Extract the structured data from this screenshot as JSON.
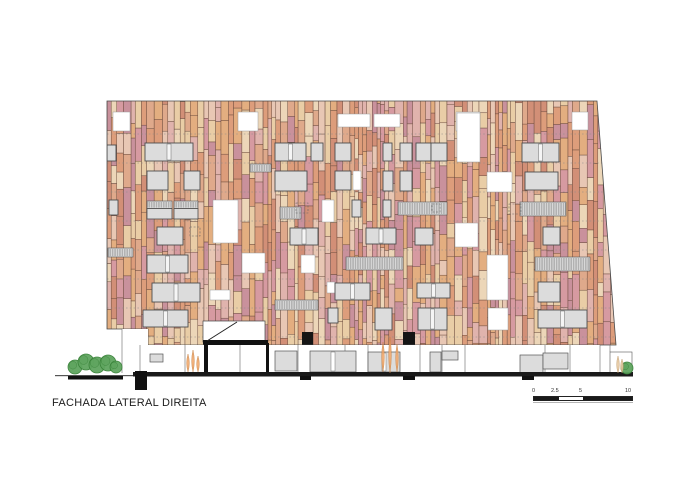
{
  "title": "FACHADA LATERAL DIREITA",
  "scale_bar": {
    "labels": [
      "0",
      "2.5",
      "5",
      "10"
    ]
  },
  "drawing": {
    "canvas": {
      "w": 700,
      "h": 495
    },
    "facade": {
      "clip_polygon": [
        [
          107,
          101
        ],
        [
          597,
          101
        ],
        [
          616,
          345
        ],
        [
          148,
          345
        ],
        [
          148,
          329
        ],
        [
          107,
          329
        ]
      ],
      "x0": 107,
      "x1": 617,
      "y_top": 101,
      "y_bottom": 345,
      "seed": 1337,
      "palette": [
        "#e3ae80",
        "#dd9d7b",
        "#d69aa1",
        "#e8c7b4",
        "#e9cda6",
        "#d28f77",
        "#c9919c",
        "#ecd6b8",
        "#dfa98b",
        "#e0b3ad"
      ],
      "plank_outline": "#6a4a3c",
      "edge_color": "#4a4a4a",
      "floor_line_ys": [
        134,
        163,
        192,
        221,
        250,
        279,
        308,
        337
      ],
      "floor_line_color": "#8a8a8a"
    },
    "window_colors": {
      "glass": "#dcdcdc",
      "frame": "#4d4d4d",
      "open": "#ffffff",
      "open_stroke": "#999999",
      "louver": "#d8d8d8",
      "louver_line": "#777777",
      "dark": "#151515",
      "dash": "#666666",
      "mullion": "#f5f5f5"
    },
    "windows": [
      [
        113,
        112,
        17,
        19,
        "o"
      ],
      [
        238,
        112,
        20,
        19,
        "o"
      ],
      [
        338,
        114,
        32,
        13,
        "o"
      ],
      [
        374,
        114,
        26,
        13,
        "o"
      ],
      [
        456,
        112,
        24,
        19,
        "o"
      ],
      [
        572,
        112,
        16,
        18,
        "o"
      ],
      [
        107,
        145,
        9,
        16,
        "g"
      ],
      [
        145,
        143,
        48,
        18,
        "g2"
      ],
      [
        275,
        143,
        31,
        18,
        "g2"
      ],
      [
        311,
        143,
        12,
        18,
        "g"
      ],
      [
        335,
        143,
        16,
        18,
        "g"
      ],
      [
        383,
        143,
        9,
        18,
        "g"
      ],
      [
        400,
        143,
        12,
        18,
        "g"
      ],
      [
        416,
        143,
        15,
        18,
        "g"
      ],
      [
        431,
        143,
        16,
        18,
        "g"
      ],
      [
        457,
        113,
        23,
        49,
        "o"
      ],
      [
        522,
        143,
        37,
        19,
        "g2"
      ],
      [
        147,
        171,
        21,
        19,
        "g"
      ],
      [
        184,
        171,
        16,
        19,
        "g"
      ],
      [
        250,
        164,
        21,
        8,
        "l"
      ],
      [
        275,
        171,
        32,
        20,
        "g"
      ],
      [
        335,
        171,
        16,
        19,
        "g"
      ],
      [
        353,
        171,
        8,
        19,
        "o"
      ],
      [
        383,
        171,
        10,
        20,
        "g"
      ],
      [
        400,
        171,
        12,
        20,
        "g"
      ],
      [
        487,
        172,
        25,
        20,
        "o"
      ],
      [
        525,
        172,
        33,
        18,
        "g"
      ],
      [
        109,
        200,
        9,
        15,
        "g"
      ],
      [
        147,
        201,
        25,
        18,
        "gl"
      ],
      [
        174,
        201,
        24,
        18,
        "gl"
      ],
      [
        213,
        200,
        25,
        43,
        "o"
      ],
      [
        280,
        207,
        21,
        12,
        "l"
      ],
      [
        322,
        200,
        12,
        22,
        "o"
      ],
      [
        352,
        200,
        9,
        17,
        "g"
      ],
      [
        383,
        200,
        8,
        17,
        "g"
      ],
      [
        398,
        202,
        49,
        13,
        "l"
      ],
      [
        520,
        202,
        46,
        14,
        "l"
      ],
      [
        296,
        203,
        12,
        10,
        "dash"
      ],
      [
        509,
        204,
        12,
        10,
        "dash"
      ],
      [
        432,
        204,
        8,
        8,
        "dash"
      ],
      [
        157,
        227,
        26,
        18,
        "g"
      ],
      [
        190,
        227,
        10,
        9,
        "dash"
      ],
      [
        290,
        228,
        28,
        17,
        "g2"
      ],
      [
        366,
        228,
        30,
        16,
        "g2"
      ],
      [
        415,
        228,
        18,
        17,
        "g"
      ],
      [
        455,
        223,
        23,
        24,
        "o"
      ],
      [
        543,
        227,
        17,
        18,
        "g"
      ],
      [
        108,
        248,
        25,
        9,
        "l"
      ],
      [
        147,
        255,
        41,
        18,
        "g2"
      ],
      [
        242,
        253,
        23,
        20,
        "o"
      ],
      [
        301,
        255,
        14,
        18,
        "o"
      ],
      [
        346,
        257,
        57,
        13,
        "l"
      ],
      [
        487,
        255,
        21,
        45,
        "o"
      ],
      [
        535,
        257,
        55,
        14,
        "l"
      ],
      [
        152,
        283,
        48,
        19,
        "g2"
      ],
      [
        327,
        282,
        8,
        11,
        "o"
      ],
      [
        335,
        283,
        35,
        17,
        "g2"
      ],
      [
        417,
        283,
        33,
        15,
        "g2"
      ],
      [
        538,
        282,
        22,
        20,
        "g"
      ],
      [
        210,
        290,
        20,
        10,
        "o"
      ],
      [
        275,
        300,
        43,
        10,
        "l"
      ],
      [
        143,
        310,
        45,
        17,
        "g2"
      ],
      [
        328,
        308,
        10,
        15,
        "g"
      ],
      [
        375,
        308,
        17,
        22,
        "g"
      ],
      [
        418,
        308,
        29,
        22,
        "g2"
      ],
      [
        488,
        308,
        20,
        22,
        "o"
      ],
      [
        538,
        310,
        49,
        18,
        "g2"
      ],
      [
        302,
        332,
        11,
        13,
        "d"
      ],
      [
        403,
        332,
        12,
        15,
        "d"
      ]
    ],
    "entrance": {
      "box": [
        203,
        321,
        62,
        21
      ],
      "bar": [
        203,
        340,
        65,
        4.5
      ],
      "diag": [
        207,
        341,
        237,
        322
      ]
    },
    "ground": {
      "white_areas": [
        [
          122,
          329,
          26,
          44
        ],
        [
          122,
          345,
          478,
          28
        ]
      ],
      "verticals": [
        [
          122,
          329,
          373
        ],
        [
          140,
          345,
          373
        ],
        [
          185,
          345,
          373
        ],
        [
          240,
          345,
          373
        ],
        [
          298,
          345,
          373
        ],
        [
          345,
          345,
          373
        ],
        [
          368,
          345,
          373
        ],
        [
          420,
          345,
          373
        ],
        [
          442,
          345,
          373
        ],
        [
          465,
          345,
          373
        ],
        [
          545,
          345,
          373
        ],
        [
          570,
          345,
          373
        ],
        [
          600,
          345,
          373
        ],
        [
          610,
          345,
          352
        ]
      ],
      "panels": [
        [
          150,
          354,
          13,
          8,
          "g"
        ],
        [
          275,
          351,
          22,
          20,
          "g"
        ],
        [
          310,
          351,
          46,
          21,
          "g2"
        ],
        [
          368,
          352,
          32,
          20,
          "g2"
        ],
        [
          430,
          352,
          11,
          20,
          "g"
        ],
        [
          442,
          351,
          16,
          9,
          "g"
        ],
        [
          520,
          355,
          23,
          18,
          "g"
        ],
        [
          543,
          353,
          25,
          16,
          "g"
        ]
      ],
      "posts": [
        [
          204,
          343,
          4,
          30
        ],
        [
          266,
          343,
          3,
          30
        ]
      ],
      "beam": [
        204,
        341,
        64,
        4
      ],
      "ground_line": [
        133,
        372,
        500,
        4.5
      ],
      "left_line": [
        55,
        375,
        80,
        1.2
      ],
      "planter": [
        68,
        376,
        55,
        3.5
      ],
      "big_post": [
        135,
        371,
        12,
        19
      ],
      "feet": [
        [
          300,
          376,
          11,
          4
        ],
        [
          403,
          376,
          12,
          4
        ],
        [
          522,
          376,
          12,
          4
        ]
      ],
      "right_box": [
        610,
        352,
        22,
        22
      ],
      "line_color": "#666666"
    },
    "landscape": {
      "bushes": [
        [
          75,
          367,
          7
        ],
        [
          86,
          362,
          8
        ],
        [
          97,
          365,
          8
        ],
        [
          108,
          363,
          8
        ],
        [
          116,
          367,
          6
        ],
        [
          627,
          368,
          6
        ]
      ],
      "bush_fill": "#5fa55f",
      "bush_stroke": "#378037",
      "plants": [
        {
          "stems": [
            [
              188,
              372,
              18
            ],
            [
              193,
              372,
              22
            ],
            [
              198,
              372,
              16
            ]
          ],
          "fill": "#f0a96e",
          "stroke": "#c77f3f"
        },
        {
          "stems": [
            [
              383,
              372,
              30
            ],
            [
              390,
              373,
              36
            ],
            [
              397,
              372,
              28
            ]
          ],
          "fill": "#f0a96e",
          "stroke": "#c77f3f"
        },
        {
          "stems": [
            [
              618,
              373,
              17
            ],
            [
              622,
              373,
              14
            ]
          ],
          "fill": "#e6c9a2",
          "stroke": "#c09a6b"
        }
      ]
    }
  }
}
